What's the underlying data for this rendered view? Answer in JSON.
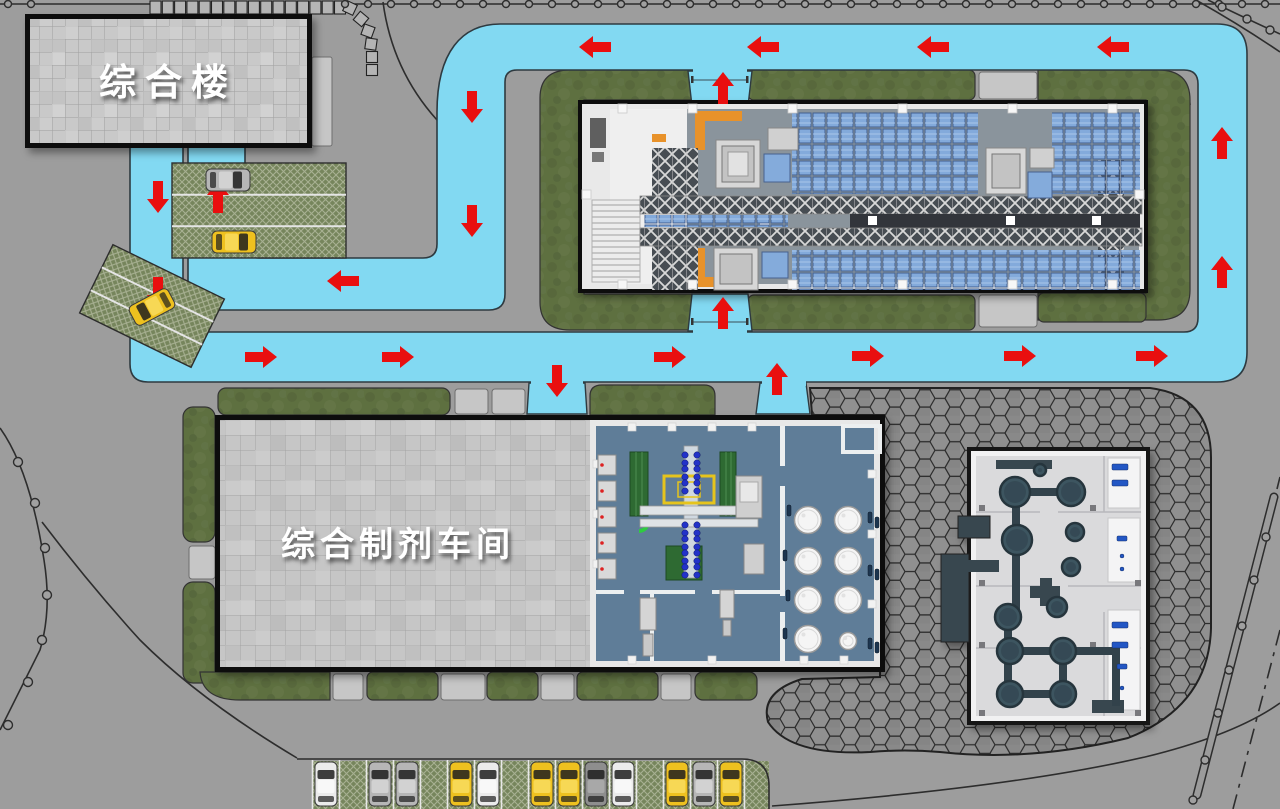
{
  "labels": {
    "admin_building": "综合楼",
    "workshop_building": "综合制剂车间"
  },
  "palette": {
    "road": "#82d9f2",
    "road_edge": "#2e3a40",
    "arrow": "#e90f0f",
    "grass": "#5e7040",
    "concrete": "#9d9d9d",
    "roof_tile": "#c9c9c9",
    "workshop_floor": "#5f7d98",
    "warehouse_floor": "#8a949c",
    "utility_floor": "#dadadc",
    "tank_dark": "#3c5560",
    "pallet_blue": "#83aadb"
  },
  "traffic_arrows": [
    {
      "x": 595,
      "y": 47,
      "dir": "left"
    },
    {
      "x": 763,
      "y": 47,
      "dir": "left"
    },
    {
      "x": 933,
      "y": 47,
      "dir": "left"
    },
    {
      "x": 1113,
      "y": 47,
      "dir": "left"
    },
    {
      "x": 472,
      "y": 107,
      "dir": "down"
    },
    {
      "x": 472,
      "y": 221,
      "dir": "down"
    },
    {
      "x": 343,
      "y": 281,
      "dir": "left"
    },
    {
      "x": 218,
      "y": 197,
      "dir": "up"
    },
    {
      "x": 158,
      "y": 197,
      "dir": "down"
    },
    {
      "x": 158,
      "y": 293,
      "dir": "down"
    },
    {
      "x": 261,
      "y": 357,
      "dir": "right"
    },
    {
      "x": 398,
      "y": 357,
      "dir": "right"
    },
    {
      "x": 670,
      "y": 357,
      "dir": "right"
    },
    {
      "x": 868,
      "y": 356,
      "dir": "right"
    },
    {
      "x": 1020,
      "y": 356,
      "dir": "right"
    },
    {
      "x": 1152,
      "y": 356,
      "dir": "right"
    },
    {
      "x": 1222,
      "y": 143,
      "dir": "up"
    },
    {
      "x": 1222,
      "y": 272,
      "dir": "up"
    },
    {
      "x": 723,
      "y": 88,
      "dir": "up"
    },
    {
      "x": 723,
      "y": 313,
      "dir": "up"
    },
    {
      "x": 557,
      "y": 381,
      "dir": "down"
    },
    {
      "x": 777,
      "y": 379,
      "dir": "up"
    }
  ],
  "vehicles": {
    "south_lot_y": 784,
    "south_lot": [
      {
        "x": 326,
        "color": "white"
      },
      {
        "x": 380,
        "color": "silver"
      },
      {
        "x": 407,
        "color": "silver"
      },
      {
        "x": 461,
        "color": "yellow"
      },
      {
        "x": 488,
        "color": "white"
      },
      {
        "x": 542,
        "color": "yellow"
      },
      {
        "x": 569,
        "color": "yellow"
      },
      {
        "x": 596,
        "color": "grey"
      },
      {
        "x": 623,
        "color": "white"
      },
      {
        "x": 677,
        "color": "yellow"
      },
      {
        "x": 704,
        "color": "silver"
      },
      {
        "x": 731,
        "color": "yellow"
      }
    ],
    "west_lot": [
      {
        "cx": 228,
        "cy": 180,
        "rot": 90,
        "color": "silver"
      },
      {
        "cx": 234,
        "cy": 242,
        "rot": 90,
        "color": "yellow"
      },
      {
        "cx": 152,
        "cy": 307,
        "rot": 242,
        "color": "yellow"
      }
    ]
  },
  "fence": {
    "top_posts_start": 345,
    "top_posts_step": 23,
    "top_posts_count": 41,
    "top_left_posts": [
      [
        8,
        4
      ],
      [
        31,
        4
      ]
    ],
    "left_posts": [
      [
        18,
        462
      ],
      [
        35,
        503
      ],
      [
        45,
        548
      ],
      [
        47,
        595
      ],
      [
        42,
        640
      ],
      [
        28,
        682
      ],
      [
        8,
        725
      ]
    ],
    "right_guardrail_posts": [
      [
        1266,
        537
      ],
      [
        1254,
        580
      ],
      [
        1242,
        626
      ],
      [
        1229,
        670
      ],
      [
        1218,
        713
      ],
      [
        1205,
        760
      ],
      [
        1193,
        800
      ]
    ],
    "top_right_posts": [
      [
        1222,
        7
      ],
      [
        1247,
        19
      ],
      [
        1270,
        30
      ]
    ]
  },
  "stepping_stones": [
    [
      350,
      8,
      25
    ],
    [
      361,
      19,
      40
    ],
    [
      368,
      31,
      20
    ],
    [
      371,
      44,
      8
    ],
    [
      372,
      57,
      0
    ],
    [
      372,
      70,
      0
    ]
  ]
}
